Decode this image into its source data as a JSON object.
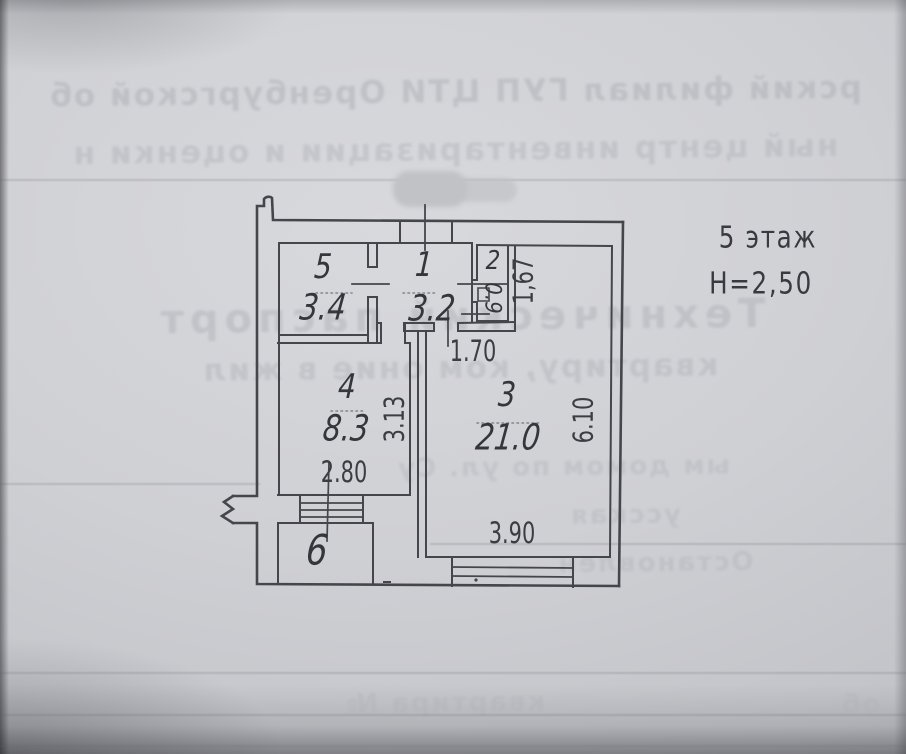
{
  "annotations": {
    "floor": "5 этаж",
    "ceiling_height": "H=2,50"
  },
  "rooms": {
    "r1": {
      "number": "1",
      "area": "3.2"
    },
    "r2": {
      "number": "2",
      "area": "0.9"
    },
    "r3": {
      "number": "3",
      "area": "21.0"
    },
    "r4": {
      "number": "4",
      "area": "8.3"
    },
    "r5": {
      "number": "5",
      "area": "3.4"
    },
    "r6": {
      "number": "6"
    }
  },
  "dimensions": {
    "dim_1_67": "1,67",
    "dim_1_70": "1.70",
    "dim_3_13": "3.13",
    "dim_6_10": "6.10",
    "dim_2_80": "2.80",
    "dim_3_90": "3.90"
  },
  "bleed_through": {
    "line1": "рский филиал ГУП ЦТИ Оренбургской об",
    "line2": "ный центр инвентаризации и оценки н",
    "title": "Технический паспорт",
    "line4": "квартиру, ком        оние в жил",
    "line5": "ым домом по ул. Су",
    "line6": "усская",
    "line7": "Остановлен",
    "line8": "квартира №",
    "line8b": "об"
  },
  "colors": {
    "paper": "#cbccd0",
    "ink": "#45464b",
    "bleed": "#aeb1b8"
  }
}
